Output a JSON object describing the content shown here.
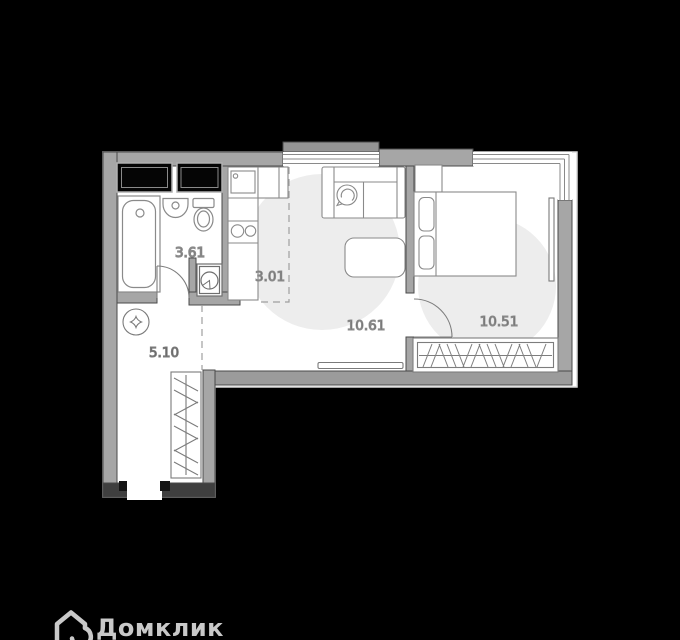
{
  "branding": {
    "logo_text": "Домклик"
  },
  "rooms": {
    "bathroom": {
      "area": "3.61"
    },
    "kitchen": {
      "area": "3.01"
    },
    "living_room": {
      "area": "10.61"
    },
    "bedroom": {
      "area": "10.51"
    },
    "hallway": {
      "area": "5.10"
    }
  },
  "colors": {
    "background": "#000000",
    "floor": "#ffffff",
    "walls": "#a6a6a6",
    "wall_outline": "#4a4a4a",
    "floor_shading": "#ededed",
    "furniture_outline": "#8a8a8a",
    "label_text": "#3c3c3c",
    "logo": "#c9c9c9"
  }
}
